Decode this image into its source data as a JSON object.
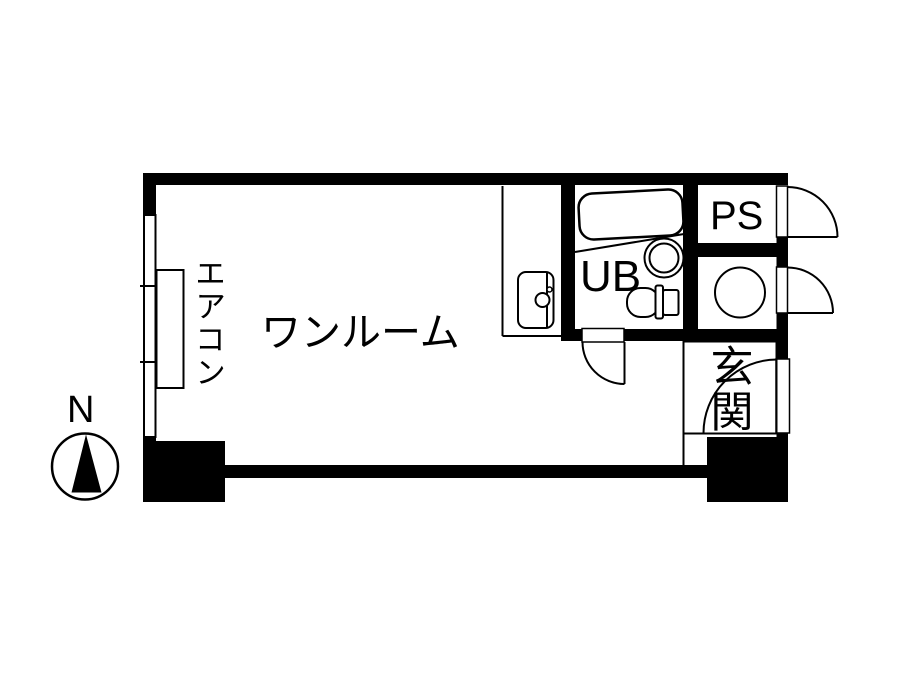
{
  "floor_plan": {
    "type": "japanese-apartment-floor-plan",
    "labels": {
      "main_room": "ワンルーム",
      "air_conditioner": "エアコン",
      "unit_bath": "UB",
      "pipe_space": "PS",
      "entrance": "玄関",
      "compass_north": "N"
    },
    "fixtures": [
      "window",
      "air-conditioner-unit",
      "kitchen-sink",
      "bathtub",
      "round-washbasin",
      "toilet",
      "washing-machine-space",
      "entrance-door",
      "pipe-space-access-doors",
      "unit-bath-door",
      "north-compass"
    ],
    "colors": {
      "wall": "#000000",
      "line": "#000000",
      "background": "#ffffff"
    }
  }
}
